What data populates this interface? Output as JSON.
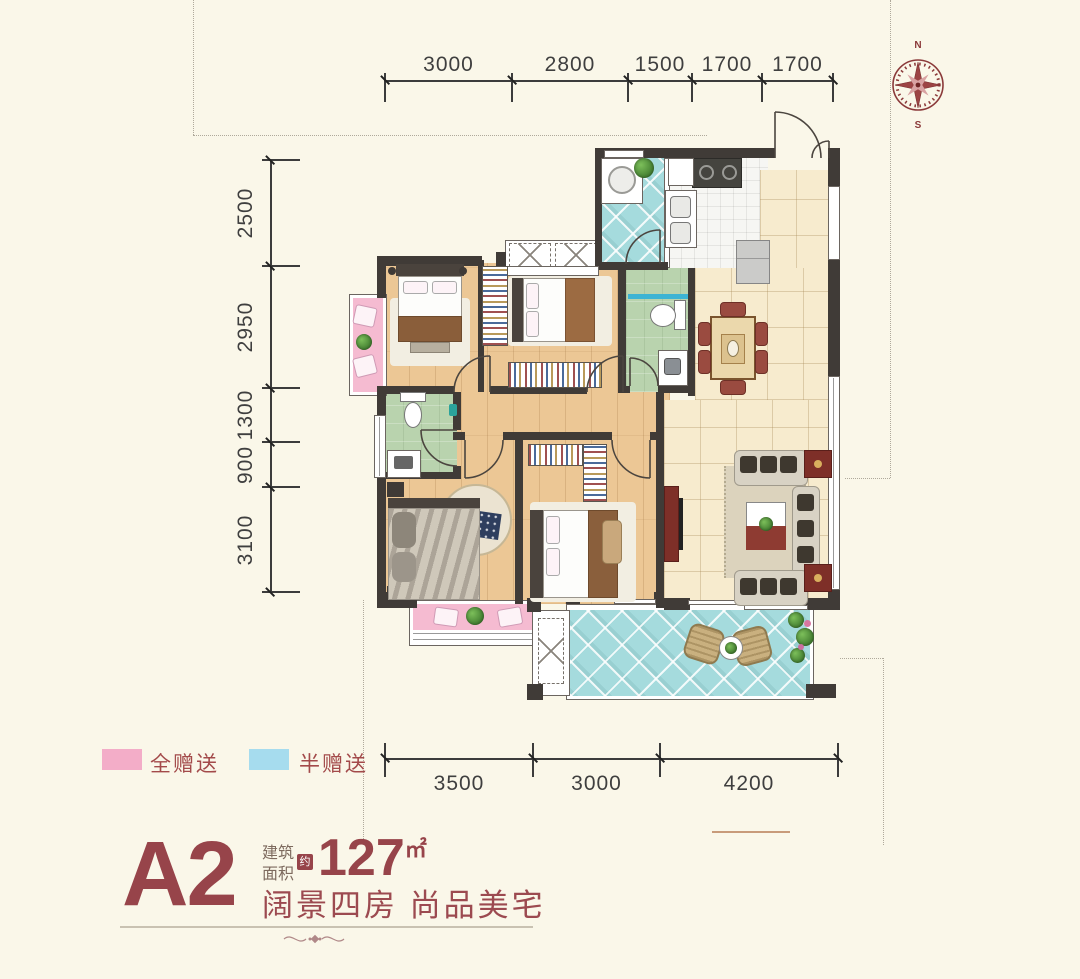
{
  "compass": {
    "north": "N",
    "south": "S"
  },
  "dimensions": {
    "top": [
      "3000",
      "2800",
      "1500",
      "1700",
      "1700"
    ],
    "left": [
      "2500",
      "2950",
      "1300",
      "900",
      "3100"
    ],
    "bottom": [
      "3500",
      "3000",
      "4200"
    ]
  },
  "legend": {
    "items": [
      {
        "label": "全赠送",
        "color": "#F3ADC8"
      },
      {
        "label": "半赠送",
        "color": "#A6DCEE"
      }
    ]
  },
  "unit_info": {
    "unit_name": "A2",
    "area_label_line1": "建筑",
    "area_label_line2": "面积",
    "area_approx": "约",
    "area_value": "127",
    "area_unit": "㎡",
    "tagline": "阔景四房 尚品美宅"
  },
  "colors": {
    "accent_maroon": "#97444A",
    "legend_pink": "#F3ADC8",
    "legend_blue": "#A6DCEE",
    "gift_full_pink": "#F5BBD1",
    "gift_half_blue": "#A5DBDD",
    "wall_dark": "#403B37",
    "background_cream": "#FAF7E9"
  }
}
